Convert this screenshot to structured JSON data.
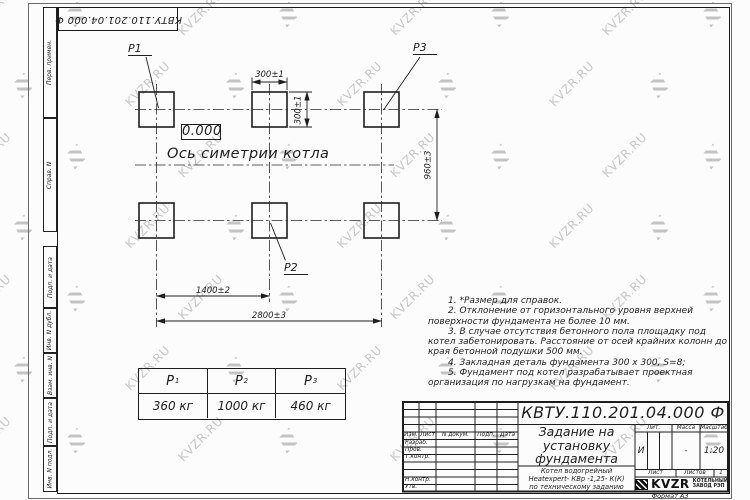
{
  "watermark": {
    "text": "KVZR.RU"
  },
  "frame": {
    "format_label": "Формат А3",
    "top_stamp": "КВТУ.110.201.04.000  Ф",
    "margin_labels": [
      "Перв. примен.",
      "Справ. N",
      "Подп. и дата",
      "Инв. N дубл.",
      "Взам. инв. N",
      "Подп. и дата",
      "Инв. N подл."
    ]
  },
  "drawing": {
    "elevation": "0.000",
    "axis_label": "Ось симетрии котла",
    "labels": {
      "p1": "Р1",
      "p2": "Р2",
      "p3": "Р3"
    },
    "dims": {
      "top_width": "300±1",
      "top_height": "300±1",
      "rows": "960±3",
      "mid": "1400±2",
      "full": "2800±3"
    }
  },
  "notes": [
    "1. *Размер для справок.",
    "2. Отклонение от горизонтального уровня верхней поверхности фундамента не более 10 мм.",
    "3. В случае отсутствия бетонного пола площадку под котел забетонировать. Расстояние от осей крайних колонн до края бетонной подушки 500 мм.",
    "4. Закладная деталь фундамента  300 х 300, S=8;",
    "5. Фундамент под котел разрабатывает проектная организация по нагрузкам на фундамент."
  ],
  "load_table": {
    "headers": [
      {
        "name": "Р",
        "sub": "1"
      },
      {
        "name": "Р",
        "sub": "2"
      },
      {
        "name": "Р",
        "sub": "3"
      }
    ],
    "values": [
      "360  кг",
      "1000 кг",
      "460  кг"
    ]
  },
  "title_block": {
    "doc_number": "КВТУ.110.201.04.000  Ф",
    "title": "Задание на установку фундамента",
    "subtitle_lines": [
      "Котел водогрейный",
      "Heatexpert- КВр -1,25- К(К)",
      "по техническому заданию"
    ],
    "change_header": [
      "Изм.",
      "Лист",
      "N докум.",
      "Подп.",
      "Дата"
    ],
    "staff_rows": [
      "Разраб.",
      "Пров.",
      "Т.контр.",
      "",
      "",
      "Н.контр.",
      "Утв."
    ],
    "lit_label": "Лит.",
    "mass_label": "Масса",
    "scale_label": "Масштаб",
    "lit_value": "И",
    "mass_value": "-",
    "scale_value": "1:20",
    "sheet_label": "Лист",
    "sheets_label": "Листов",
    "sheets_value": "1",
    "brand": {
      "name": "KVZR",
      "caption_lines": [
        "КОТЕЛЬНЫЙ",
        "ЗАВОД РЭП"
      ]
    }
  }
}
